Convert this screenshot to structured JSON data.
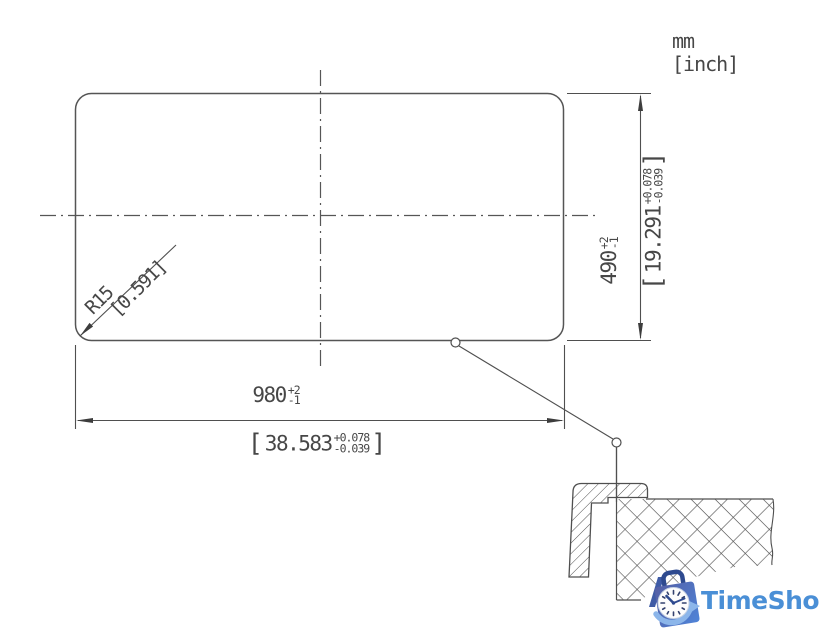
{
  "drawing": {
    "units": {
      "primary": "mm",
      "secondary": "[inch]"
    },
    "width_dim": {
      "mm": {
        "value": "980",
        "plus": "+2",
        "minus": "-1"
      },
      "inch": {
        "open": "[",
        "value": "38.583",
        "plus": "+0.078",
        "minus": "-0.039",
        "close": "]"
      }
    },
    "height_dim": {
      "mm": {
        "value": "490",
        "plus": "+2",
        "minus": "-1"
      },
      "inch": {
        "open": "[",
        "value": "19.291",
        "plus": "+0.078",
        "minus": "-0.039",
        "close": "]"
      }
    },
    "radius_dim": {
      "mm": "R15",
      "inch": "[0.591]"
    }
  },
  "logo": {
    "name": "TimeShop"
  },
  "colors": {
    "line": "#4f4f4f",
    "text": "#474747",
    "logo_blue": "#4a8fd6",
    "logo_bag_dark": "#2e4a8f",
    "logo_bag_grad_start": "#545ea4",
    "logo_bag_grad_end": "#4f84d8",
    "logo_swoosh": "#8cb6ea"
  }
}
